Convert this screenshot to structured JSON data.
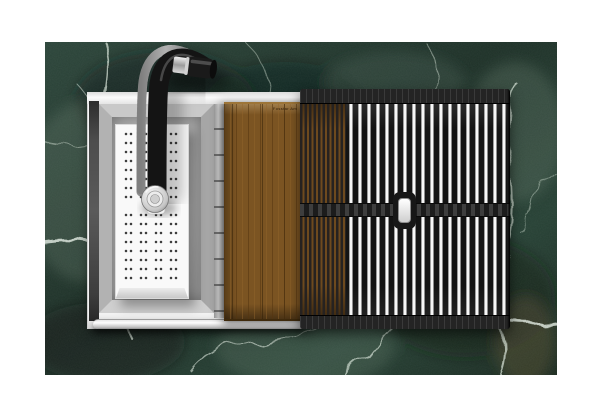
{
  "meta": {
    "kind": "product-photo",
    "canvas": {
      "width": 600,
      "height": 420
    },
    "background_color": "#ffffff",
    "description": "Top-down photo of a stainless workstation sink set in green marble: gooseneck pull-down faucet, perforated colander board in the bowl, walnut cutting board, and roll-up drying rack with stainless rods"
  },
  "countertop": {
    "material": "green marble",
    "colors": {
      "base": "#24382e",
      "dark_patch": "#14231b",
      "light_mottle": "#6d8273",
      "vein": "#dde8dd",
      "brown_accent": "#6a5a34"
    }
  },
  "sink": {
    "label": "workstation-sink",
    "colors": {
      "rim": "#f2f2f2",
      "basin_wall": "#b0b0b0",
      "basin_floor": "#b9b9b9",
      "left_shadow": "#3d3d3d",
      "front_rail": "#d9d9d9",
      "ledge_rail": "#c9c9c9"
    }
  },
  "faucet": {
    "label": "gooseneck-pulldown-faucet",
    "colors": {
      "chrome": "#cccccc",
      "body_black": "#141414",
      "sprayer": "#e8e8e8"
    }
  },
  "colander": {
    "label": "perforated-colander-board",
    "colors": {
      "body": "#f9f9f9",
      "holes": "#3d3d3d",
      "side_face": "#d6d6d6"
    }
  },
  "cutting_board": {
    "label": "walnut-cutting-board",
    "colors": {
      "wood": "#7b5422",
      "grain": "#54350f",
      "edge_highlight": "#9d7538"
    },
    "stamp_text": "Fosstar Am"
  },
  "drying_rack": {
    "label": "roll-up-drying-rack",
    "colors": {
      "mat": "#1e1e1e",
      "rod": "#f6f6f6",
      "slat": "#262220",
      "wood_through_gaps": "#6e4a1e",
      "handle_grip": "#ececec"
    }
  }
}
